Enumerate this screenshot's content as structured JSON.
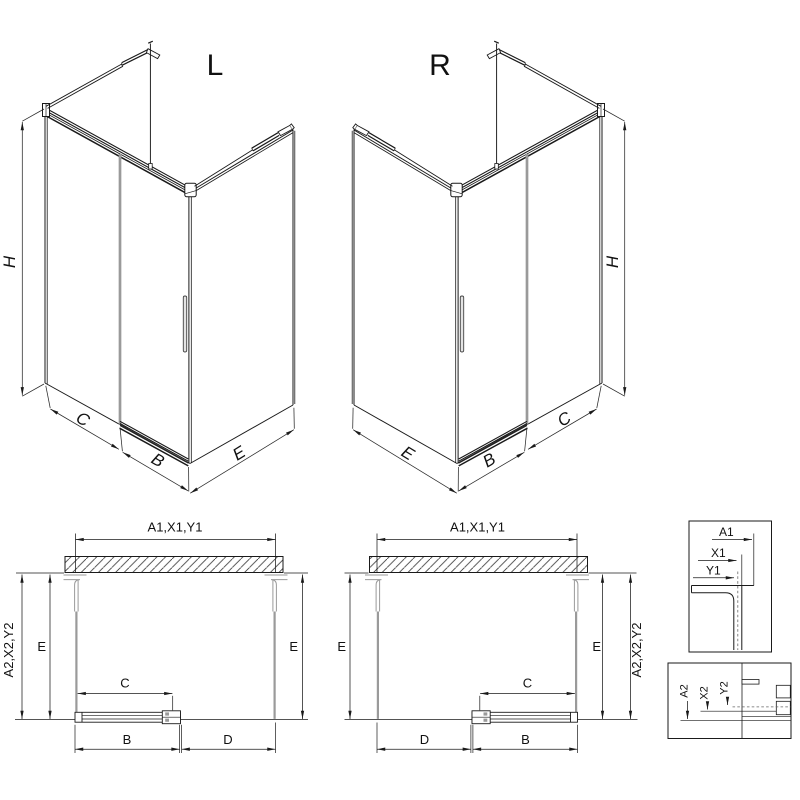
{
  "sheet": {
    "background": "#ffffff",
    "line_color": "#1a1a1a",
    "profile_gray": "#9a9a9a"
  },
  "iso_left": {
    "variant": "L",
    "dim_height": "H",
    "dim_fixed_front": "C",
    "dim_door": "B",
    "dim_side": "E"
  },
  "iso_right": {
    "variant": "R",
    "dim_height": "H",
    "dim_fixed_front": "C",
    "dim_door": "B",
    "dim_side": "E"
  },
  "plan_left": {
    "dim_width_top": "A1,X1,Y1",
    "dim_depth_outer": "A2,X2,Y2",
    "dim_depth_left": "E",
    "dim_depth_right": "E",
    "dim_door_travel": "C",
    "dim_door_panel": "B",
    "dim_entry": "D"
  },
  "plan_right": {
    "dim_width_top": "A1,X1,Y1",
    "dim_depth_outer": "A2,X2,Y2",
    "dim_depth_left": "E",
    "dim_depth_right": "E",
    "dim_door_travel": "C",
    "dim_door_panel": "B",
    "dim_entry": "D"
  },
  "detail_wall_profile": {
    "labels": [
      "A1",
      "X1",
      "Y1"
    ]
  },
  "detail_floor_profile": {
    "labels": [
      "A2",
      "X2",
      "Y2"
    ]
  }
}
